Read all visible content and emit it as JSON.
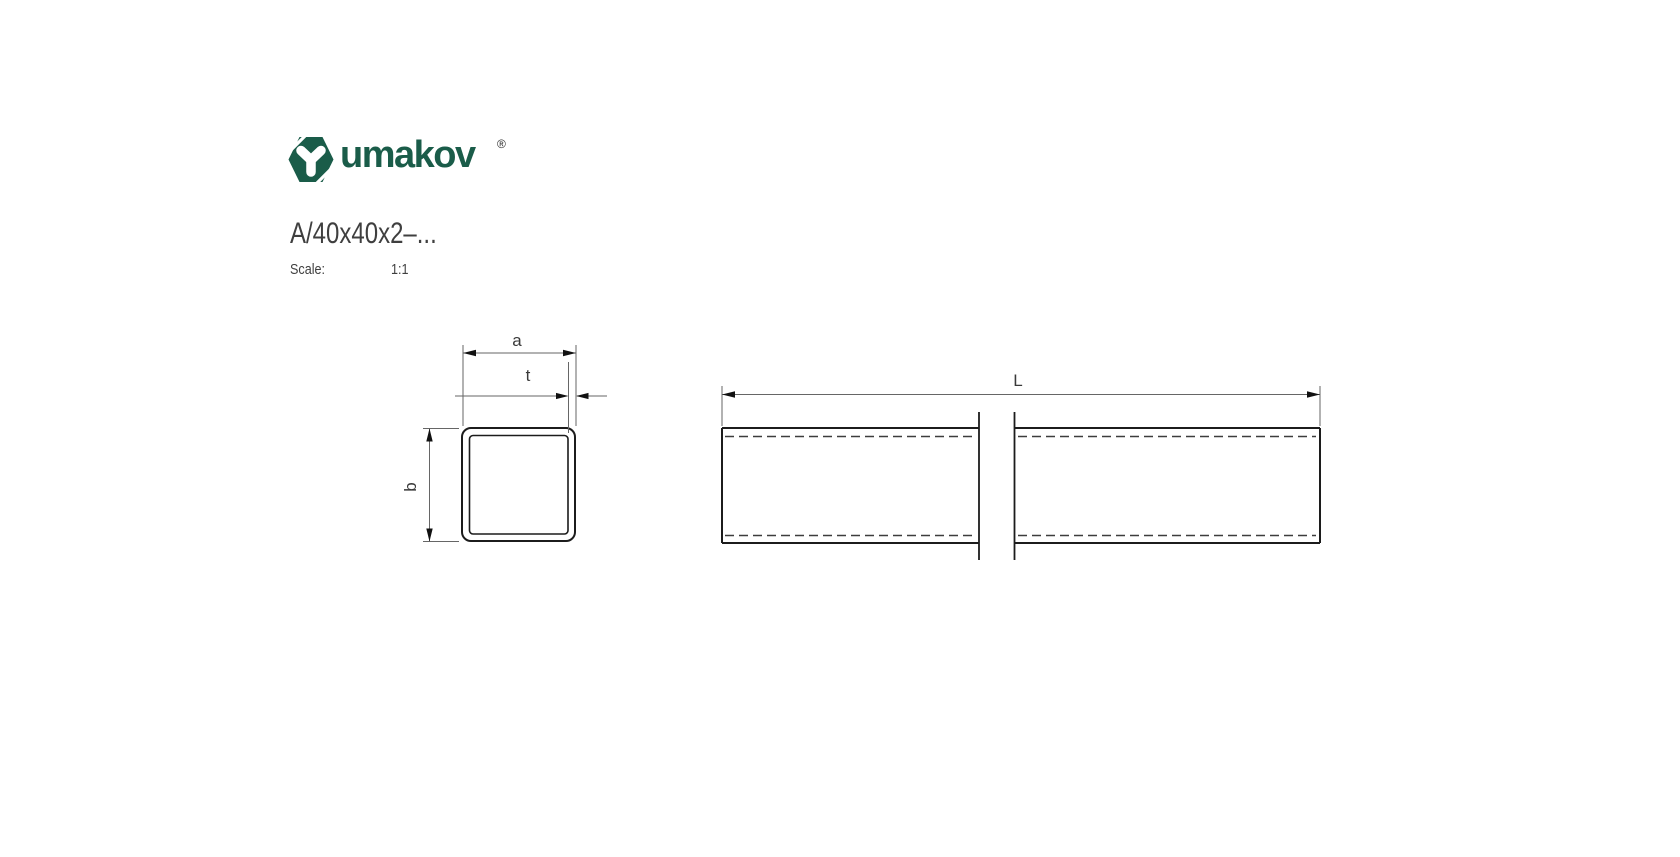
{
  "page": {
    "background": "#ffffff"
  },
  "brand": {
    "logo_text": "umakov",
    "registered_mark": "®",
    "logo_color": "#1a5c49",
    "icon": "hexagon-y-logo"
  },
  "header": {
    "title": "A/40x40x2–...",
    "scale_label": "Scale:",
    "scale_value": "1:1"
  },
  "drawing": {
    "kind": "technical-drawing",
    "line_color": "#1f1f1f",
    "dim_color": "#666666",
    "hidden_line_color": "#3d3d3d",
    "cross_section": {
      "description": "square hollow tube cross-section",
      "labels": {
        "width": "a",
        "thickness": "t",
        "height": "b"
      }
    },
    "side_view": {
      "description": "tube side view with break lines",
      "labels": {
        "length": "L"
      }
    }
  }
}
